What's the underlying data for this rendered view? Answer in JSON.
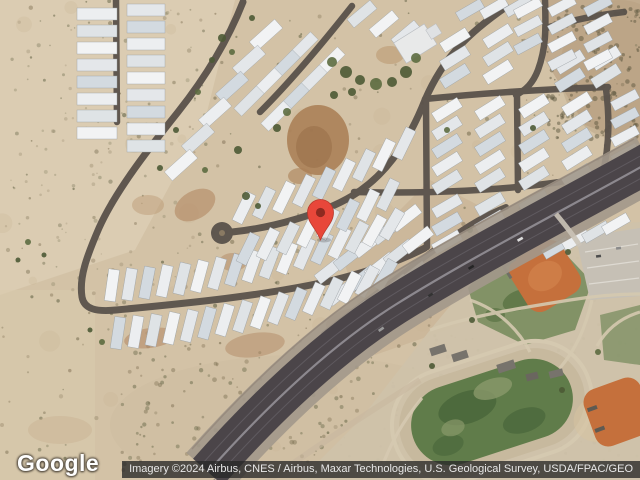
{
  "map": {
    "provider_logo": "Google",
    "attribution": "Imagery ©2024 Airbus, CNES / Airbus, Maxar Technologies, U.S. Geological Survey, USDA/FPAC/GEO",
    "marker": {
      "color": "#E8473A",
      "inner_color": "#8E2A20",
      "tip_x": 320,
      "tip_y": 240
    },
    "palette": {
      "desert": "#d3c2a6",
      "road": "#5b534c",
      "highway": "#4b4549",
      "highway_shoulder": "#a2988b",
      "house": "#eceef0",
      "field_green": "#607c4a",
      "infield_orange": "#c5703c",
      "park_ground": "#cfc2aa",
      "dirt_red": "#ab8158"
    }
  }
}
